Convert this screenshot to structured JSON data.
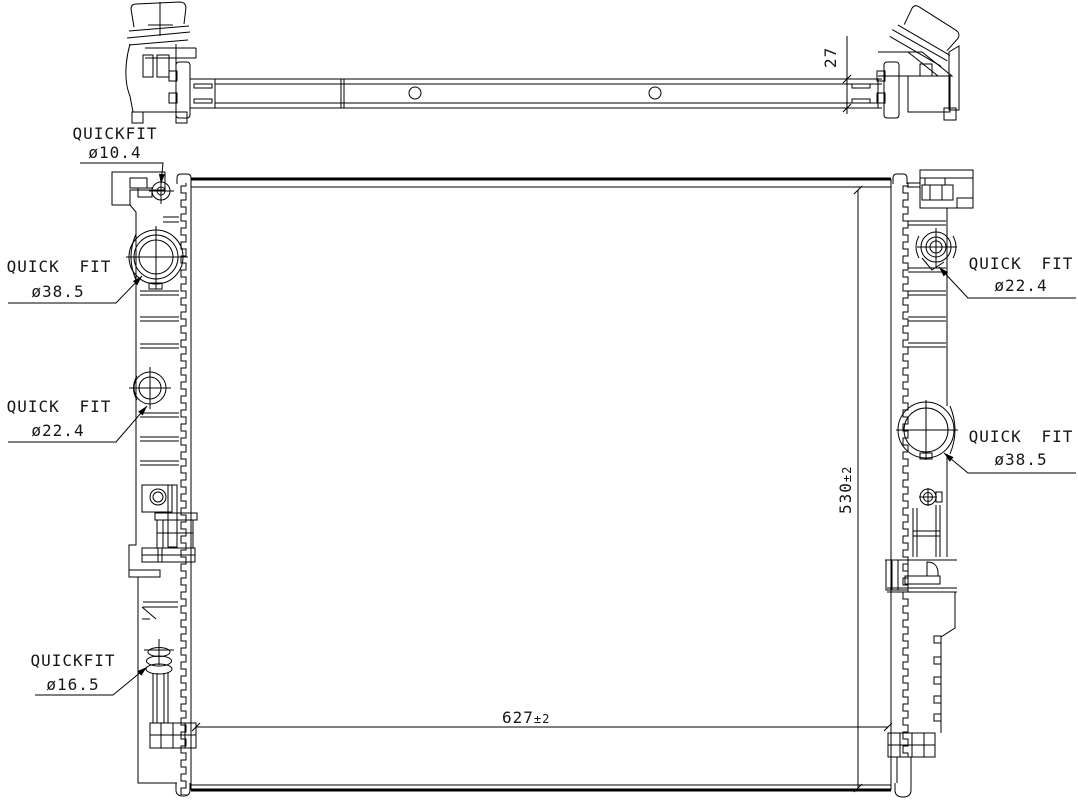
{
  "drawing": {
    "background": "#ffffff",
    "line_color": "#000000",
    "text_color": "#161616"
  },
  "callouts": {
    "top_pin": {
      "name": "QUICKFIT",
      "size": "ø10.4"
    },
    "left_upper": {
      "name": "QUICK FIT",
      "size": "ø38.5"
    },
    "left_mid": {
      "name": "QUICK FIT",
      "size": "ø22.4"
    },
    "left_bottom": {
      "name": "QUICKFIT",
      "size": "ø16.5"
    },
    "right_upper": {
      "name": "QUICK FIT",
      "size": "ø22.4"
    },
    "right_lower": {
      "name": "QUICK FIT",
      "size": "ø38.5"
    }
  },
  "dimensions": {
    "tank_depth": {
      "value": "27",
      "tolerance": ""
    },
    "core_height": {
      "value": "530",
      "tolerance": "±2"
    },
    "core_width": {
      "value": "627",
      "tolerance": "±2"
    }
  }
}
